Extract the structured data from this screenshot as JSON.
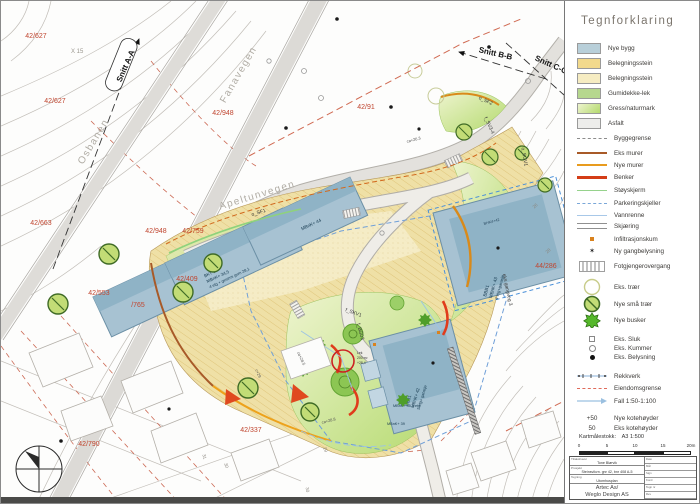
{
  "legend": {
    "title": "Tegnforklaring",
    "area_items": [
      {
        "label": "Nye bygg",
        "color": "#b8cfd9"
      },
      {
        "label": "Belegningsstein",
        "color": "#f2d98c"
      },
      {
        "label": "Belegningsstein",
        "color": "#f6ecc2"
      },
      {
        "label": "Gumidekke-lek",
        "color": "#b6d78e"
      },
      {
        "label": "Gress/naturmark",
        "color": "#cde690"
      },
      {
        "label": "Asfalt",
        "color": "#ededeb"
      }
    ],
    "line_items": [
      {
        "label": "Byggegrense",
        "color": "#8c8c8c"
      },
      {
        "label": "Eks murer",
        "color": "#a85a28"
      },
      {
        "label": "Nye murer",
        "color": "#e89b1e"
      },
      {
        "label": "Benker",
        "color": "#d43d17"
      },
      {
        "label": "Støyskjerm",
        "color": "#96d28c"
      },
      {
        "label": "Parkeringskjeller",
        "color": "#7aa7d8"
      },
      {
        "label": "Vannrenne",
        "color": "#a8c8e8"
      },
      {
        "label": "Skjæring",
        "color": "#909090"
      }
    ],
    "symbol_items": [
      {
        "label": "Infiltrasjonskum"
      },
      {
        "label": "Ny gangbelysning"
      },
      {
        "label": "Fotgjengerovergang"
      },
      {
        "label": "Eks. trær"
      },
      {
        "label": "Nye små trær"
      },
      {
        "label": "Nye busker"
      },
      {
        "label": "Eks. Sluk"
      },
      {
        "label": "Eks. Kummer"
      },
      {
        "label": "Eks. Belysning"
      },
      {
        "label": "Rekkverk"
      },
      {
        "label": "Eiendomsgrense"
      },
      {
        "label": "Fall 1:50-1:100"
      }
    ],
    "kote_items": [
      {
        "prefix": "+50",
        "label": "Nye kotehøyder"
      },
      {
        "prefix": "50",
        "label": "Eks kotehøyder"
      }
    ],
    "scale_caption": "Kartmålestokk:",
    "scale_value": "A3 1:500",
    "scale_ticks": [
      "0",
      "5",
      "10",
      "15",
      "20m"
    ]
  },
  "titleblock": {
    "rows": [
      {
        "label": "Tiltakshaver",
        "value": "Tone Blørvik"
      },
      {
        "label": "Prosjekt",
        "value": "Steinsvikvn. gnr 42, bnr 408 A-5"
      },
      {
        "label": "Tegning",
        "value": "Utomhusplan"
      }
    ],
    "firm_label": "Utarb. firma",
    "firm1": "Artec As/",
    "firm2": "Weglo Design AS",
    "fields": [
      "Dato",
      "Mål",
      "Sign",
      "Kontr",
      "Tegn nr",
      "Rev"
    ]
  },
  "map": {
    "road_labels": [
      "Osbanen",
      "Fanavegen",
      "Apeltunvegen"
    ],
    "sections": [
      "Snitt A-A",
      "Snitt B-B",
      "Snitt C-C"
    ],
    "parcels": [
      "42/627",
      "42/627",
      "42/948",
      "42/948",
      "42/91",
      "42/759",
      "42/409",
      "42/663",
      "42/553",
      "/765",
      "42/790",
      "42/337",
      "44/286"
    ],
    "survey_point": "X 15",
    "zones": [
      "o_SF1",
      "o_SF2",
      "f_SV3-4",
      "o_SGV1",
      "f_SKV1",
      "f_BG03",
      "eks gangveg 3"
    ],
    "elevations": [
      "ca+26.3",
      "ca+28.5",
      "c+29",
      "ca+28.8"
    ],
    "contour_numbers": [
      "31",
      "30",
      "29",
      "30",
      "28",
      "26"
    ],
    "buildings": {
      "left_top": "MBnK+ 44",
      "left_main": [
        "BKT 1",
        "MBnK+ 34,5",
        "4 etg + gesims gum 28,1"
      ],
      "right_tag": "BHK4+42",
      "right_main": [
        "BBB1",
        "MBnK+ 43",
        "4 etg+garasje"
      ],
      "bottom_main": [
        "BBB1",
        "MBnK+ 42",
        "5 etg+ garasje"
      ],
      "bottom_sub1": "MBnK+ 45  5 etg",
      "bottom_sub2": "MBnK+ 39"
    },
    "playground_note": [
      "Lek",
      "200 m²",
      "+28,4"
    ]
  }
}
